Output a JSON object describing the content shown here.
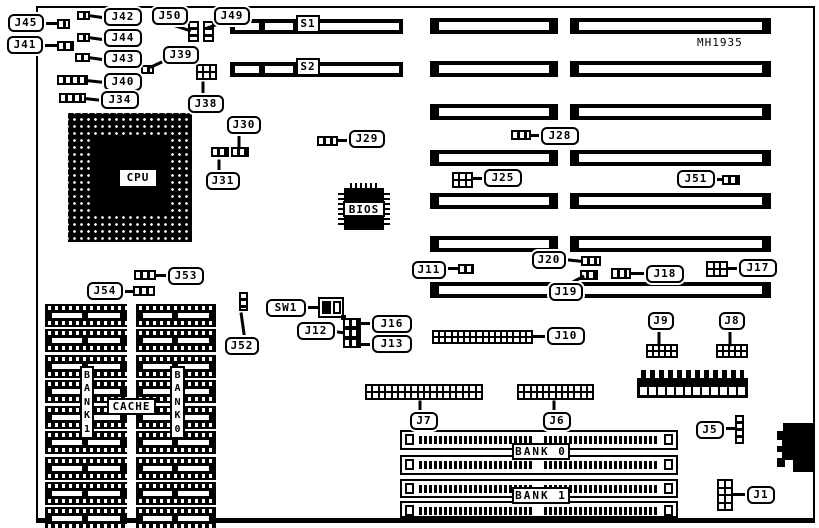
{
  "board": {
    "part_number": "MH1935"
  },
  "slots": {
    "s1": "S1",
    "s2": "S2"
  },
  "chips": {
    "cpu": "CPU",
    "bios": "BIOS"
  },
  "cache": {
    "title": "CACHE",
    "bank1_vertical": "B\nA\nN\nK\n1",
    "bank0_vertical": "B\nA\nN\nK\n0"
  },
  "memory": {
    "bank0": "BANK 0",
    "bank1": "BANK 1"
  },
  "callouts": {
    "j45": "J45",
    "j41": "J41",
    "j42": "J42",
    "j44": "J44",
    "j43": "J43",
    "j40": "J40",
    "j34": "J34",
    "j50": "J50",
    "j49": "J49",
    "j39": "J39",
    "j38": "J38",
    "j30": "J30",
    "j31": "J31",
    "j29": "J29",
    "j28": "J28",
    "j25": "J25",
    "j51": "J51",
    "j11": "J11",
    "j20": "J20",
    "j18": "J18",
    "j17": "J17",
    "j19": "J19",
    "j53": "J53",
    "j54": "J54",
    "sw1": "SW1",
    "j12": "J12",
    "j16": "J16",
    "j13": "J13",
    "j52": "J52",
    "j10": "J10",
    "j9": "J9",
    "j8": "J8",
    "j7": "J7",
    "j6": "J6",
    "j5": "J5",
    "j1": "J1"
  }
}
